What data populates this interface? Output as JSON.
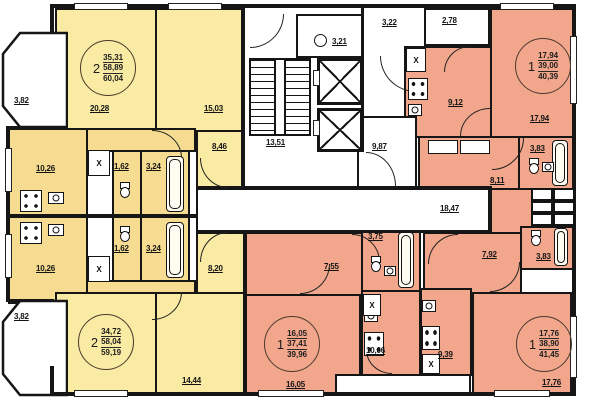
{
  "plan": {
    "kind": "residential-floor-plan"
  },
  "palette": {
    "room_yellow": "#F9EBA3",
    "service_yellow": "#F6DC90",
    "salmon": "#F2A78C",
    "wall": "#161616",
    "background": "#FFFFFF"
  },
  "symbols": {
    "vent": "X"
  },
  "apartments": [
    {
      "id": "apt-2room-top-left",
      "rooms": "2",
      "l1": "35,31",
      "l2": "58,89",
      "l3": "60,04"
    },
    {
      "id": "apt-1room-top-right",
      "rooms": "1",
      "l1": "17,94",
      "l2": "39,00",
      "l3": "40,39"
    },
    {
      "id": "apt-2room-bottom-left",
      "rooms": "2",
      "l1": "34,72",
      "l2": "58,04",
      "l3": "59,19"
    },
    {
      "id": "apt-1room-bottom-mid",
      "rooms": "1",
      "l1": "16,05",
      "l2": "37,41",
      "l3": "39,96"
    },
    {
      "id": "apt-1room-bottom-right",
      "rooms": "1",
      "l1": "17,76",
      "l2": "38,90",
      "l3": "41,45"
    }
  ],
  "labels": {
    "bay_top": "3,82",
    "room_a_tl": "20,28",
    "room_b_tl": "15,03",
    "hall_tl": "8,46",
    "kitchen_tl": "10,26",
    "wc_tl": "1,62",
    "bath_tl": "3,24",
    "wc_bl": "1,62",
    "bath_bl": "3,24",
    "kitchen_bl": "10,26",
    "bay_bottom": "3,82",
    "hall_bl": "8,20",
    "room_b_bl": "14,44",
    "stairs": "13,51",
    "chute": "3,21",
    "lift_hall": "3,22",
    "lobby": "9,87",
    "corridor": "18,47",
    "balcony_tr": "2,78",
    "kitchen_tr": "9,12",
    "room_tr": "17,94",
    "bath_tr": "3,83",
    "hall_tr": "8,11",
    "bath_bm": "3,75",
    "hall_bm": "7,55",
    "room_bm": "16,05",
    "kitchen_bm": "10,06",
    "hall_br": "7,92",
    "bath_br": "3,83",
    "kitchen_br": "9,39",
    "room_br": "17,76"
  }
}
